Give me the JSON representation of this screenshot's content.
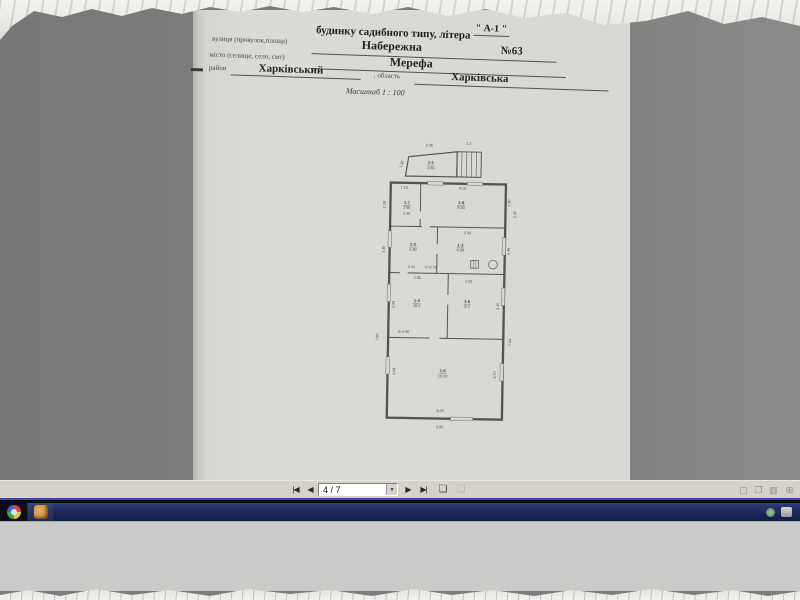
{
  "document": {
    "header": {
      "title_line": "будинку садибного типу, літера",
      "litera": "\" А-1 \"",
      "street_label": "вулиця (провулок,площа)",
      "street_value": "Набережна",
      "street_number": "№63",
      "city_label": "місто (селище, село, смт)",
      "city_value": "Мерефа",
      "district_label": "район",
      "district_value": "Харківський",
      "region_label": ", область",
      "region_value": "Харківська",
      "scale": "Масштаб 1 : 100"
    },
    "plan": {
      "rooms": [
        {
          "id": "1-1",
          "area": "2.80"
        },
        {
          "id": "1-7",
          "area": "2.90"
        },
        {
          "id": "1-8",
          "area": "9.80"
        },
        {
          "id": "1-2",
          "area": "5.90"
        },
        {
          "id": "1-3",
          "area": "6.30"
        },
        {
          "id": "1-4",
          "area": "10.2"
        },
        {
          "id": "1-5",
          "area": "8.2"
        },
        {
          "id": "1-6",
          "area": "19.50"
        }
      ],
      "dims": [
        "2.35",
        "1.2",
        "1.35",
        "1.15",
        "4.15",
        "2.28",
        "2.80",
        "2.40",
        "2.90",
        "2.93",
        "2.35",
        "2.46",
        "2.41",
        "h=2.75",
        "2.90",
        "3.29",
        "3.44",
        "3.40",
        "h=2.90",
        "7.60",
        "7.64",
        "3.08",
        "3.70",
        "5.29",
        "5.95"
      ]
    }
  },
  "viewer_toolbar": {
    "page_indicator": "4 / 7",
    "glyphs": {
      "first_page": "|◀",
      "prev_page": "◀",
      "next_page": "▶",
      "last_page": "▶|",
      "dropdown_arrow": "▼",
      "export_page": "❏",
      "copy_page": "❏",
      "view_single": "▢",
      "view_facing": "❐",
      "view_thumbs": "▥",
      "view_fit": "⊞"
    }
  },
  "taskbar": {
    "apps": [
      {
        "name": "browser"
      },
      {
        "name": "image-viewer"
      }
    ],
    "tray": [
      {
        "name": "status-green"
      },
      {
        "name": "status-gray"
      }
    ]
  },
  "colors": {
    "canvas_gray": "#7d7d7d",
    "page_paper": "#d8d7d3",
    "toolbar_gray": "#d5d2cb",
    "taskbar_navy": "#1d2b5e",
    "plan_ink": "#4c4a46"
  }
}
